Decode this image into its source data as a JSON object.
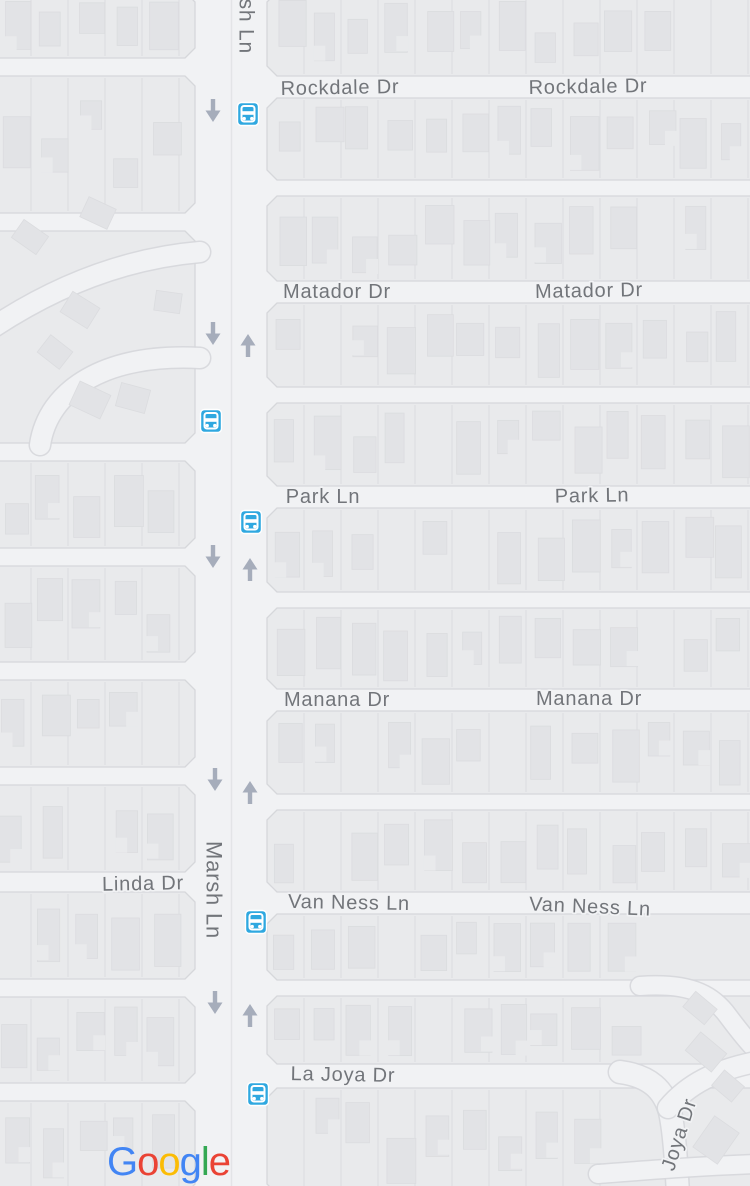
{
  "map": {
    "attribution": "Google",
    "colors": {
      "road": "#f1f2f4",
      "land": "#e9eaec",
      "block_border": "#d6d7db",
      "parcel_line": "#d9dade",
      "building": "#e2e3e6",
      "building_border": "#dbdcdf",
      "label": "#72757a",
      "label_halo": "#f1f2f4",
      "bus_blue": "#2fa8e0",
      "bus_glyph": "#ffffff",
      "arrow": "#a6adbb",
      "center_line": "#e3e4e7"
    },
    "streets": {
      "main_vertical": {
        "name": "Marsh Ln",
        "x_left": 195,
        "x_right": 267
      },
      "east_labeled": [
        {
          "name": "Rockdale Dr",
          "y": 87
        },
        {
          "name": "Matador Dr",
          "y": 292
        },
        {
          "name": "Park Ln",
          "y": 497
        },
        {
          "name": "Manana Dr",
          "y": 700
        },
        {
          "name": "Van Ness Ln",
          "y": 903
        },
        {
          "name": "La Joya Dr",
          "y": 1076
        }
      ],
      "east_unlabeled_y": [
        188,
        395,
        600,
        802,
        988
      ],
      "west_labeled": [
        {
          "name": "Linda Dr",
          "y": 882
        }
      ],
      "west_unlabeled_y": [
        67,
        222,
        452,
        557,
        671,
        776,
        988,
        1092
      ],
      "diagonal": [
        {
          "name": "Joya Dr"
        }
      ]
    },
    "labels": {
      "horizontal": [
        {
          "text": "Rockdale Dr",
          "x": 340,
          "y": 88,
          "tilt": -1
        },
        {
          "text": "Rockdale Dr",
          "x": 588,
          "y": 87,
          "tilt": -1
        },
        {
          "text": "Matador Dr",
          "x": 337,
          "y": 292,
          "tilt": 0
        },
        {
          "text": "Matador Dr",
          "x": 589,
          "y": 291,
          "tilt": -1
        },
        {
          "text": "Park Ln",
          "x": 323,
          "y": 497,
          "tilt": 0
        },
        {
          "text": "Park Ln",
          "x": 592,
          "y": 496,
          "tilt": -1
        },
        {
          "text": "Manana Dr",
          "x": 337,
          "y": 700,
          "tilt": 0
        },
        {
          "text": "Manana Dr",
          "x": 589,
          "y": 699,
          "tilt": 0
        },
        {
          "text": "Van Ness Ln",
          "x": 349,
          "y": 903,
          "tilt": 1
        },
        {
          "text": "Van Ness Ln",
          "x": 590,
          "y": 907,
          "tilt": 2.5
        },
        {
          "text": "La Joya Dr",
          "x": 343,
          "y": 1075,
          "tilt": 1
        },
        {
          "text": "Linda Dr",
          "x": 143,
          "y": 884,
          "tilt": -1
        }
      ],
      "vertical": [
        {
          "text": "Marsh Ln",
          "x": 246,
          "y": -40,
          "rotate": 90,
          "anchor": "start",
          "size": 21
        },
        {
          "text": "Marsh Ln",
          "x": 214,
          "y": 890,
          "rotate": 90,
          "anchor": "middle",
          "size": 22
        },
        {
          "text": "Joya Dr",
          "x": 668,
          "y": 1170,
          "rotate": -72,
          "anchor": "start",
          "size": 20
        }
      ]
    },
    "transit_stops": [
      {
        "x": 248,
        "y": 114
      },
      {
        "x": 211,
        "y": 421
      },
      {
        "x": 251,
        "y": 522
      },
      {
        "x": 256,
        "y": 922
      },
      {
        "x": 258,
        "y": 1094
      }
    ],
    "one_way_arrows": {
      "down": [
        {
          "x": 213,
          "y": 112
        },
        {
          "x": 213,
          "y": 335
        },
        {
          "x": 213,
          "y": 558
        },
        {
          "x": 215,
          "y": 781
        },
        {
          "x": 215,
          "y": 1004
        }
      ],
      "up": [
        {
          "x": 248,
          "y": 344
        },
        {
          "x": 250,
          "y": 568
        },
        {
          "x": 250,
          "y": 791
        },
        {
          "x": 250,
          "y": 1014
        }
      ]
    },
    "google_logo": {
      "letters": [
        {
          "ch": "G",
          "color": "#4285F4"
        },
        {
          "ch": "o",
          "color": "#EA4335"
        },
        {
          "ch": "o",
          "color": "#FBBC05"
        },
        {
          "ch": "g",
          "color": "#4285F4"
        },
        {
          "ch": "l",
          "color": "#34A853"
        },
        {
          "ch": "e",
          "color": "#EA4335"
        }
      ]
    }
  }
}
